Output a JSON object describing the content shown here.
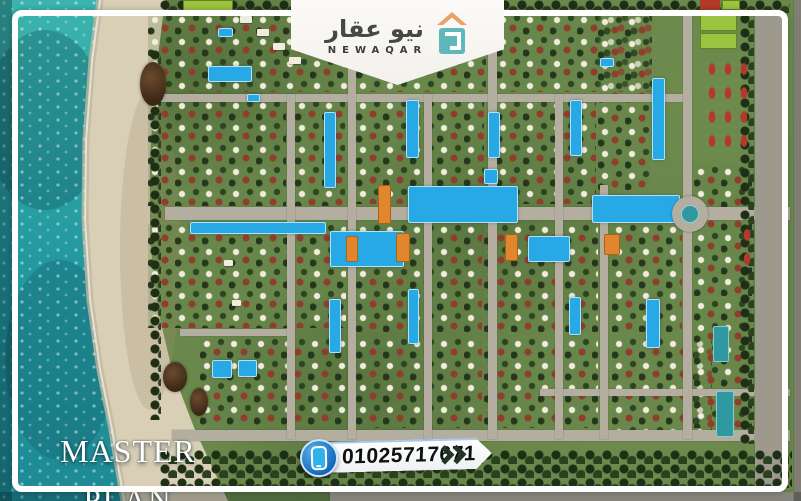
{
  "branding": {
    "logo_arabic": "نيو عقار",
    "logo_english": "NEWAQAR",
    "logo_icon": "house-roof-over-teal-square"
  },
  "contact": {
    "phone_number": "01025717671",
    "phone_icon": "smartphone-icon",
    "chevron_icon": "double-chevron-right"
  },
  "caption": {
    "line1": "MASTER",
    "line2": "PLAN"
  },
  "palette": {
    "ocean_teal": "#2aa3a3",
    "sand": "#d8cfb6",
    "land_green": "#6a884c",
    "road_gray": "#b3aea0",
    "pool_blue": "#27a9e6",
    "lagoon_teal": "#2f98a0",
    "clubhouse_orange": "#e0862c",
    "court_lime": "#9bc43f",
    "roof_red": "#b23a28",
    "frame_white": "#ffffff",
    "phone_circle_blue": "#1173c9",
    "logo_text_gray": "#474747",
    "chevron_dark": "#223425"
  },
  "map": {
    "features": [
      {
        "cls": "villas",
        "x": 148,
        "y": 14,
        "w": 200,
        "h": 78
      },
      {
        "cls": "villas",
        "x": 148,
        "y": 100,
        "w": 138,
        "h": 106
      },
      {
        "cls": "villas",
        "x": 295,
        "y": 100,
        "w": 50,
        "h": 106
      },
      {
        "cls": "villas",
        "x": 356,
        "y": 14,
        "w": 130,
        "h": 78
      },
      {
        "cls": "villas",
        "x": 496,
        "y": 14,
        "w": 156,
        "h": 78
      },
      {
        "cls": "villas",
        "x": 356,
        "y": 100,
        "w": 128,
        "h": 104
      },
      {
        "cls": "villas",
        "x": 496,
        "y": 100,
        "w": 100,
        "h": 104
      },
      {
        "cls": "villas",
        "x": 598,
        "y": 16,
        "w": 52,
        "h": 174
      },
      {
        "cls": "villas",
        "x": 148,
        "y": 224,
        "w": 198,
        "h": 104
      },
      {
        "cls": "villas",
        "x": 200,
        "y": 338,
        "w": 146,
        "h": 88
      },
      {
        "cls": "villas",
        "x": 356,
        "y": 224,
        "w": 126,
        "h": 108
      },
      {
        "cls": "villas",
        "x": 484,
        "y": 224,
        "w": 114,
        "h": 108
      },
      {
        "cls": "villas",
        "x": 612,
        "y": 224,
        "w": 70,
        "h": 108
      },
      {
        "cls": "villas",
        "x": 356,
        "y": 338,
        "w": 126,
        "h": 90
      },
      {
        "cls": "villas",
        "x": 484,
        "y": 338,
        "w": 114,
        "h": 90
      },
      {
        "cls": "villas",
        "x": 612,
        "y": 338,
        "w": 100,
        "h": 94
      },
      {
        "cls": "villas",
        "x": 694,
        "y": 166,
        "w": 58,
        "h": 130
      },
      {
        "cls": "villas",
        "x": 694,
        "y": 300,
        "w": 58,
        "h": 128
      },
      {
        "cls": "road",
        "x": 150,
        "y": 94,
        "w": 540,
        "h": 8
      },
      {
        "cls": "road",
        "x": 165,
        "y": 207,
        "w": 625,
        "h": 13
      },
      {
        "cls": "road",
        "x": 180,
        "y": 329,
        "w": 112,
        "h": 7
      },
      {
        "cls": "road",
        "x": 540,
        "y": 389,
        "w": 250,
        "h": 7
      },
      {
        "cls": "road",
        "x": 172,
        "y": 430,
        "w": 618,
        "h": 11
      },
      {
        "cls": "road",
        "x": 330,
        "y": 492,
        "w": 471,
        "h": 9
      },
      {
        "cls": "road",
        "x": 287,
        "y": 94,
        "w": 8,
        "h": 345
      },
      {
        "cls": "road",
        "x": 348,
        "y": 16,
        "w": 8,
        "h": 423
      },
      {
        "cls": "road",
        "x": 424,
        "y": 94,
        "w": 8,
        "h": 345
      },
      {
        "cls": "road",
        "x": 488,
        "y": 16,
        "w": 9,
        "h": 423
      },
      {
        "cls": "road",
        "x": 555,
        "y": 94,
        "w": 8,
        "h": 345
      },
      {
        "cls": "road",
        "x": 600,
        "y": 185,
        "w": 8,
        "h": 254
      },
      {
        "cls": "road",
        "x": 683,
        "y": 16,
        "w": 9,
        "h": 423
      },
      {
        "cls": "road-dark",
        "x": 755,
        "y": 12,
        "w": 30,
        "h": 477
      },
      {
        "cls": "road-dark",
        "x": 794,
        "y": 0,
        "w": 7,
        "h": 501
      },
      {
        "cls": "trees",
        "x": 160,
        "y": 0,
        "w": 630,
        "h": 13
      },
      {
        "cls": "trees",
        "x": 160,
        "y": 450,
        "w": 632,
        "h": 38
      },
      {
        "cls": "trees-col",
        "x": 740,
        "y": 14,
        "w": 14,
        "h": 430
      },
      {
        "cls": "trees-col",
        "x": 150,
        "y": 50,
        "w": 11,
        "h": 370
      },
      {
        "cls": "court-lime",
        "x": 183,
        "y": 0,
        "w": 50,
        "h": 11
      },
      {
        "cls": "bldg-red",
        "x": 700,
        "y": 0,
        "w": 20,
        "h": 10
      },
      {
        "cls": "court-lime",
        "x": 722,
        "y": 0,
        "w": 18,
        "h": 10
      },
      {
        "cls": "court-lime",
        "x": 700,
        "y": 14,
        "w": 37,
        "h": 17
      },
      {
        "cls": "court-lime",
        "x": 700,
        "y": 33,
        "w": 37,
        "h": 16
      },
      {
        "cls": "red-grid",
        "x": 704,
        "y": 58,
        "w": 46,
        "h": 100
      },
      {
        "cls": "red-grid",
        "x": 739,
        "y": 224,
        "w": 14,
        "h": 48
      },
      {
        "cls": "pool",
        "x": 208,
        "y": 66,
        "w": 44,
        "h": 16
      },
      {
        "cls": "pool",
        "x": 218,
        "y": 28,
        "w": 15,
        "h": 9
      },
      {
        "cls": "pool",
        "x": 247,
        "y": 94,
        "w": 13,
        "h": 8
      },
      {
        "cls": "pool",
        "x": 324,
        "y": 112,
        "w": 12,
        "h": 76
      },
      {
        "cls": "pool",
        "x": 190,
        "y": 222,
        "w": 136,
        "h": 12
      },
      {
        "cls": "pool",
        "x": 408,
        "y": 186,
        "w": 110,
        "h": 37
      },
      {
        "cls": "pool",
        "x": 592,
        "y": 195,
        "w": 88,
        "h": 28
      },
      {
        "cls": "pool",
        "x": 330,
        "y": 231,
        "w": 74,
        "h": 36
      },
      {
        "cls": "pool",
        "x": 528,
        "y": 236,
        "w": 42,
        "h": 26
      },
      {
        "cls": "pool",
        "x": 484,
        "y": 169,
        "w": 14,
        "h": 15
      },
      {
        "cls": "pool",
        "x": 652,
        "y": 78,
        "w": 13,
        "h": 82
      },
      {
        "cls": "pool",
        "x": 570,
        "y": 100,
        "w": 12,
        "h": 56
      },
      {
        "cls": "pool",
        "x": 406,
        "y": 100,
        "w": 13,
        "h": 58
      },
      {
        "cls": "pool",
        "x": 488,
        "y": 112,
        "w": 12,
        "h": 46
      },
      {
        "cls": "pool",
        "x": 600,
        "y": 58,
        "w": 14,
        "h": 9
      },
      {
        "cls": "pool",
        "x": 212,
        "y": 360,
        "w": 20,
        "h": 18
      },
      {
        "cls": "pool",
        "x": 238,
        "y": 360,
        "w": 19,
        "h": 17
      },
      {
        "cls": "pool",
        "x": 329,
        "y": 299,
        "w": 12,
        "h": 54
      },
      {
        "cls": "pool",
        "x": 408,
        "y": 289,
        "w": 11,
        "h": 55
      },
      {
        "cls": "pool",
        "x": 646,
        "y": 299,
        "w": 14,
        "h": 49
      },
      {
        "cls": "pool",
        "x": 569,
        "y": 297,
        "w": 12,
        "h": 38
      },
      {
        "cls": "pool-teal",
        "x": 716,
        "y": 391,
        "w": 18,
        "h": 46
      },
      {
        "cls": "pool-teal",
        "x": 713,
        "y": 326,
        "w": 16,
        "h": 36
      },
      {
        "cls": "bldg-orange",
        "x": 378,
        "y": 185,
        "w": 13,
        "h": 39
      },
      {
        "cls": "bldg-orange",
        "x": 396,
        "y": 233,
        "w": 14,
        "h": 29
      },
      {
        "cls": "bldg-orange",
        "x": 505,
        "y": 234,
        "w": 13,
        "h": 27
      },
      {
        "cls": "bldg-orange",
        "x": 604,
        "y": 234,
        "w": 16,
        "h": 21
      },
      {
        "cls": "bldg-orange",
        "x": 346,
        "y": 236,
        "w": 12,
        "h": 26
      },
      {
        "cls": "roundabout",
        "x": 672,
        "y": 196,
        "w": 36,
        "h": 36
      },
      {
        "cls": "pond",
        "x": 681,
        "y": 205,
        "w": 18,
        "h": 18
      },
      {
        "cls": "rock",
        "x": 140,
        "y": 62,
        "w": 26,
        "h": 44
      },
      {
        "cls": "rock",
        "x": 163,
        "y": 362,
        "w": 24,
        "h": 30
      },
      {
        "cls": "rock",
        "x": 190,
        "y": 388,
        "w": 18,
        "h": 28
      },
      {
        "cls": "deck",
        "x": 240,
        "y": 16,
        "w": 12,
        "h": 7
      },
      {
        "cls": "deck",
        "x": 257,
        "y": 29,
        "w": 12,
        "h": 7
      },
      {
        "cls": "deck",
        "x": 273,
        "y": 43,
        "w": 12,
        "h": 7
      },
      {
        "cls": "deck",
        "x": 289,
        "y": 57,
        "w": 12,
        "h": 7
      },
      {
        "cls": "deck",
        "x": 224,
        "y": 260,
        "w": 9,
        "h": 6
      },
      {
        "cls": "deck",
        "x": 232,
        "y": 300,
        "w": 9,
        "h": 6
      }
    ]
  }
}
